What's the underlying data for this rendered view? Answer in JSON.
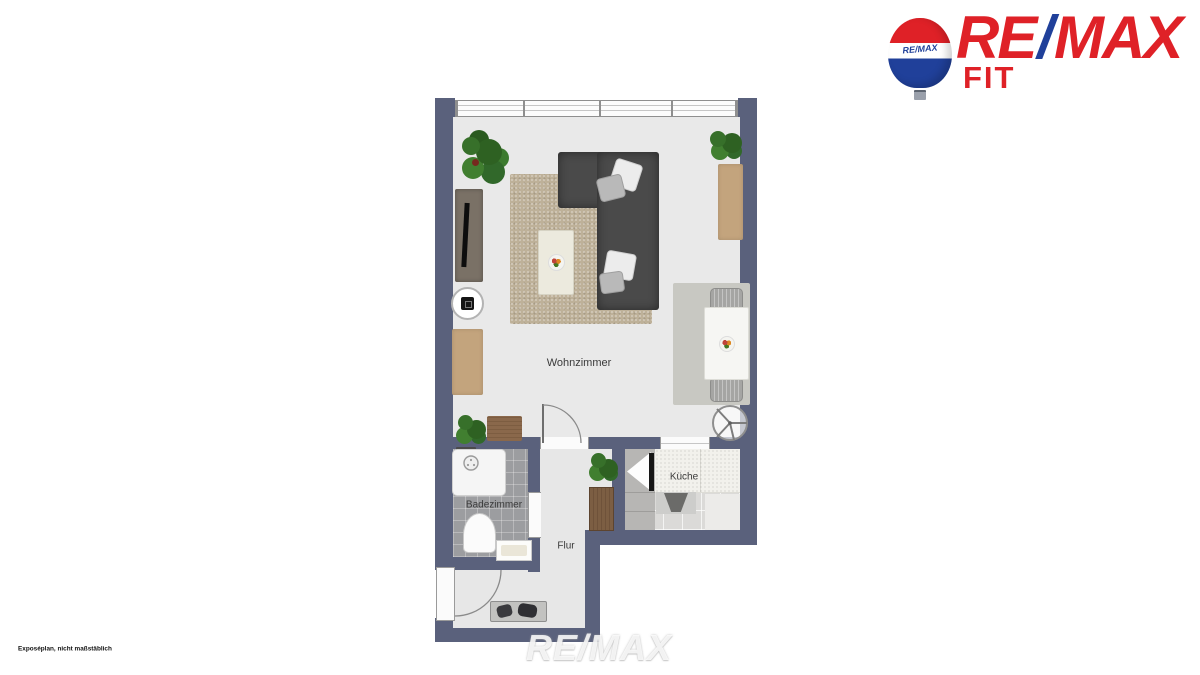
{
  "branding": {
    "logo_re": "RE",
    "logo_slash": "/",
    "logo_max": "MAX",
    "logo_sub": "FIT",
    "balloon_label": "RE/MAX"
  },
  "colors": {
    "remax_red": "#DF2127",
    "remax_blue": "#20409A",
    "wall": "#5A617C"
  },
  "rooms": [
    {
      "id": "wohnzimmer",
      "label": "Wohnzimmer"
    },
    {
      "id": "badezimmer",
      "label": "Badezimmer"
    },
    {
      "id": "flur",
      "label": "Flur"
    },
    {
      "id": "kueche",
      "label": "Küche"
    }
  ],
  "watermark": "RE/MAX",
  "disclaimer": "Exposéplan, nicht maßstäblich",
  "icons": {
    "balloon": "remax-hot-air-balloon",
    "fan": "extractor-fan-symbol",
    "shower_head": "shower-head-symbol",
    "door_arc": "door-swing-arc"
  }
}
